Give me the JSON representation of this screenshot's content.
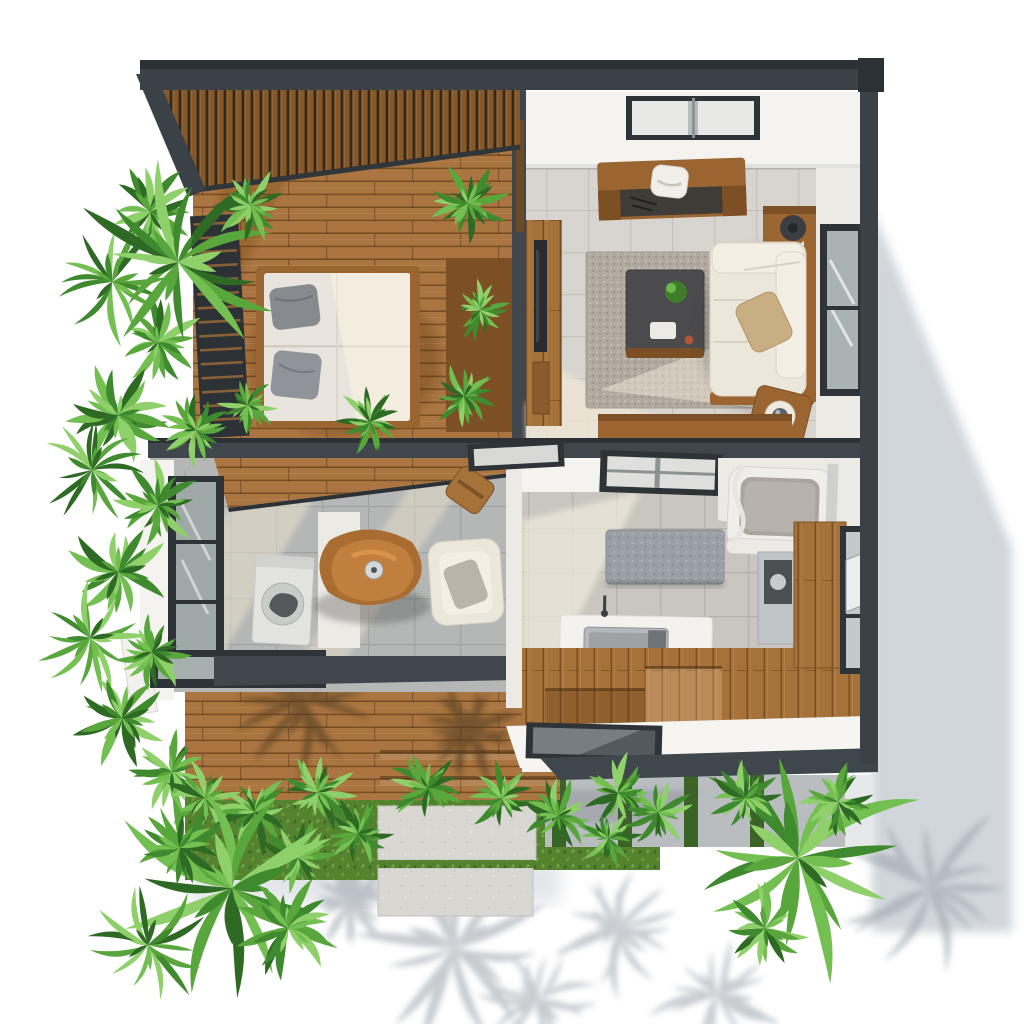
{
  "scene": {
    "description": "top-down-3d-floor-plan-render",
    "width": 1024,
    "height": 1024
  },
  "palette": {
    "white": "#ffffff",
    "roof": "#3a4147",
    "beamDark": "#2c3136",
    "beam": "#3f464c",
    "pergolaWood": "#9a6733",
    "pergolaGap": "#3c2b17",
    "deck": "#aa7540",
    "deckLine": "#7a5226",
    "woodV": "#a7713a",
    "wood": "#9a6531",
    "woodDark": "#7c4f24",
    "wall": "#f4f3ef",
    "wallShade": "#eceae5",
    "tileL": "#d8d5d0",
    "groutL": "#c5c2bb",
    "tileS": "#b5b7b6",
    "groutS": "#a0a3a2",
    "tileK": "#c9c6bf",
    "groutK": "#b5b2ab",
    "rug": "#b2aaa0",
    "sofa": "#ece7db",
    "sofaLight": "#f3efe5",
    "mattress": "#e9e5de",
    "pillowGray": "#878b8f",
    "pillowTan": "#c9ad83",
    "glass": "#aab3b4",
    "frame": "#2e3337",
    "paver": "#d9d7d1",
    "concrete": "#b9bdc0",
    "grass": "#55822f",
    "grassDark": "#3c6326",
    "shadow": "#c9cfd5",
    "steel": "#b6b9bc",
    "appliance": "#c2c5c7",
    "dark": "#4b4f52",
    "tableWood": "#c07f3c",
    "tableWoodDark": "#a96d31",
    "islandGranite": "#9aa1a6"
  },
  "greens": [
    "#2e6a24",
    "#3f8a2e",
    "#58a63c",
    "#74bf52",
    "#8fd06b"
  ],
  "regions": [
    {
      "id": "bedroom-terrace"
    },
    {
      "id": "living-room"
    },
    {
      "id": "studio-room"
    },
    {
      "id": "kitchen-bathroom"
    },
    {
      "id": "wood-deck"
    },
    {
      "id": "garden"
    }
  ],
  "objects": [
    "pergola-slat-roof",
    "bed",
    "gray-pillows",
    "louver-screen",
    "planter-box",
    "skylight",
    "desk",
    "desk-chair",
    "lamp-cabinet",
    "tv-console",
    "tv",
    "rug",
    "coffee-table",
    "sofa",
    "tan-pillow",
    "side-table",
    "window",
    "dining-table",
    "armchair",
    "washing-machine",
    "counter",
    "stool",
    "kitchen-island",
    "sink-counter",
    "sink",
    "bathtub",
    "shower-hose",
    "fridge-appliance",
    "wood-cabinet",
    "open-window",
    "deck-steps",
    "skylight-panel",
    "concrete-steps",
    "grass-strips",
    "pavers",
    "palm-plants",
    "shrub-plants",
    "building-shadow"
  ],
  "plants": [
    {
      "x": 150,
      "y": 212,
      "r": 52,
      "t": "shrub",
      "seed": 1
    },
    {
      "x": 112,
      "y": 282,
      "r": 62,
      "t": "palm",
      "rot": -15,
      "seed": 2
    },
    {
      "x": 158,
      "y": 342,
      "r": 50,
      "t": "shrub",
      "seed": 3
    },
    {
      "x": 118,
      "y": 415,
      "r": 56,
      "t": "shrub",
      "seed": 4
    },
    {
      "x": 92,
      "y": 470,
      "r": 52,
      "t": "palm",
      "rot": 150,
      "seed": 5
    },
    {
      "x": 158,
      "y": 505,
      "r": 48,
      "t": "shrub",
      "seed": 6
    },
    {
      "x": 118,
      "y": 572,
      "r": 56,
      "t": "shrub",
      "seed": 7
    },
    {
      "x": 90,
      "y": 638,
      "r": 56,
      "t": "palm",
      "rot": 30,
      "seed": 8
    },
    {
      "x": 152,
      "y": 652,
      "r": 46,
      "t": "shrub",
      "seed": 9
    },
    {
      "x": 122,
      "y": 718,
      "r": 54,
      "t": "shrub",
      "seed": 10
    },
    {
      "x": 172,
      "y": 772,
      "r": 46,
      "t": "shrub",
      "seed": 11
    },
    {
      "x": 205,
      "y": 798,
      "r": 42,
      "t": "shrub",
      "seed": 12
    },
    {
      "x": 178,
      "y": 262,
      "r": 100,
      "t": "palm",
      "rot": -20,
      "seed": 13
    },
    {
      "x": 250,
      "y": 205,
      "r": 40,
      "t": "shrub",
      "seed": 14
    },
    {
      "x": 468,
      "y": 203,
      "r": 44,
      "t": "shrub",
      "seed": 15
    },
    {
      "x": 480,
      "y": 310,
      "r": 34,
      "t": "shrub",
      "seed": 16
    },
    {
      "x": 464,
      "y": 396,
      "r": 38,
      "t": "shrub",
      "seed": 17
    },
    {
      "x": 248,
      "y": 405,
      "r": 32,
      "t": "shrub",
      "seed": 18
    },
    {
      "x": 370,
      "y": 422,
      "r": 38,
      "t": "shrub",
      "seed": 19
    },
    {
      "x": 196,
      "y": 430,
      "r": 40,
      "t": "shrub",
      "seed": 20
    },
    {
      "x": 255,
      "y": 812,
      "r": 46,
      "t": "shrub",
      "seed": 21
    },
    {
      "x": 318,
      "y": 792,
      "r": 44,
      "t": "shrub",
      "seed": 22
    },
    {
      "x": 358,
      "y": 833,
      "r": 40,
      "t": "shrub",
      "seed": 23
    },
    {
      "x": 428,
      "y": 788,
      "r": 42,
      "t": "shrub",
      "seed": 24
    },
    {
      "x": 298,
      "y": 858,
      "r": 42,
      "t": "shrub",
      "seed": 25
    },
    {
      "x": 502,
      "y": 798,
      "r": 40,
      "t": "shrub",
      "seed": 26
    },
    {
      "x": 558,
      "y": 816,
      "r": 40,
      "t": "shrub",
      "seed": 27
    },
    {
      "x": 618,
      "y": 793,
      "r": 44,
      "t": "shrub",
      "seed": 28
    },
    {
      "x": 608,
      "y": 838,
      "r": 36,
      "t": "shrub",
      "seed": 29
    },
    {
      "x": 658,
      "y": 812,
      "r": 38,
      "t": "shrub",
      "seed": 30
    },
    {
      "x": 232,
      "y": 888,
      "r": 120,
      "t": "palm",
      "rot": 10,
      "seed": 31
    },
    {
      "x": 180,
      "y": 848,
      "r": 52,
      "t": "shrub",
      "seed": 32
    },
    {
      "x": 288,
      "y": 928,
      "r": 55,
      "t": "shrub",
      "seed": 33
    },
    {
      "x": 148,
      "y": 945,
      "r": 60,
      "t": "palm",
      "rot": 80,
      "seed": 34
    },
    {
      "x": 798,
      "y": 858,
      "r": 125,
      "t": "palm",
      "rot": -5,
      "seed": 35
    },
    {
      "x": 745,
      "y": 798,
      "r": 40,
      "t": "shrub",
      "seed": 36
    },
    {
      "x": 838,
      "y": 802,
      "r": 42,
      "t": "shrub",
      "seed": 37
    },
    {
      "x": 765,
      "y": 928,
      "r": 48,
      "t": "shrub",
      "seed": 38
    }
  ],
  "ground_shadows": [
    {
      "x": 455,
      "y": 948,
      "r": 95,
      "t": "palm",
      "rot": 25,
      "seed": 41
    },
    {
      "x": 618,
      "y": 928,
      "r": 75,
      "t": "palm",
      "rot": 60,
      "seed": 42
    },
    {
      "x": 350,
      "y": 902,
      "r": 55,
      "t": "shrub",
      "seed": 43
    },
    {
      "x": 930,
      "y": 888,
      "r": 88,
      "t": "palm",
      "rot": -30,
      "seed": 44
    },
    {
      "x": 718,
      "y": 996,
      "r": 68,
      "t": "palm",
      "rot": 120,
      "seed": 45
    },
    {
      "x": 538,
      "y": 1000,
      "r": 60,
      "t": "palm",
      "rot": 200,
      "seed": 46
    }
  ],
  "deck_shadows": [
    {
      "x": 305,
      "y": 702,
      "r": 75,
      "t": "palm",
      "rot": -40,
      "seed": 47
    },
    {
      "x": 470,
      "y": 732,
      "r": 55,
      "t": "shrub",
      "seed": 48
    },
    {
      "x": 330,
      "y": 330,
      "r": 80,
      "t": "palm",
      "rot": -30,
      "seed": 49
    }
  ]
}
